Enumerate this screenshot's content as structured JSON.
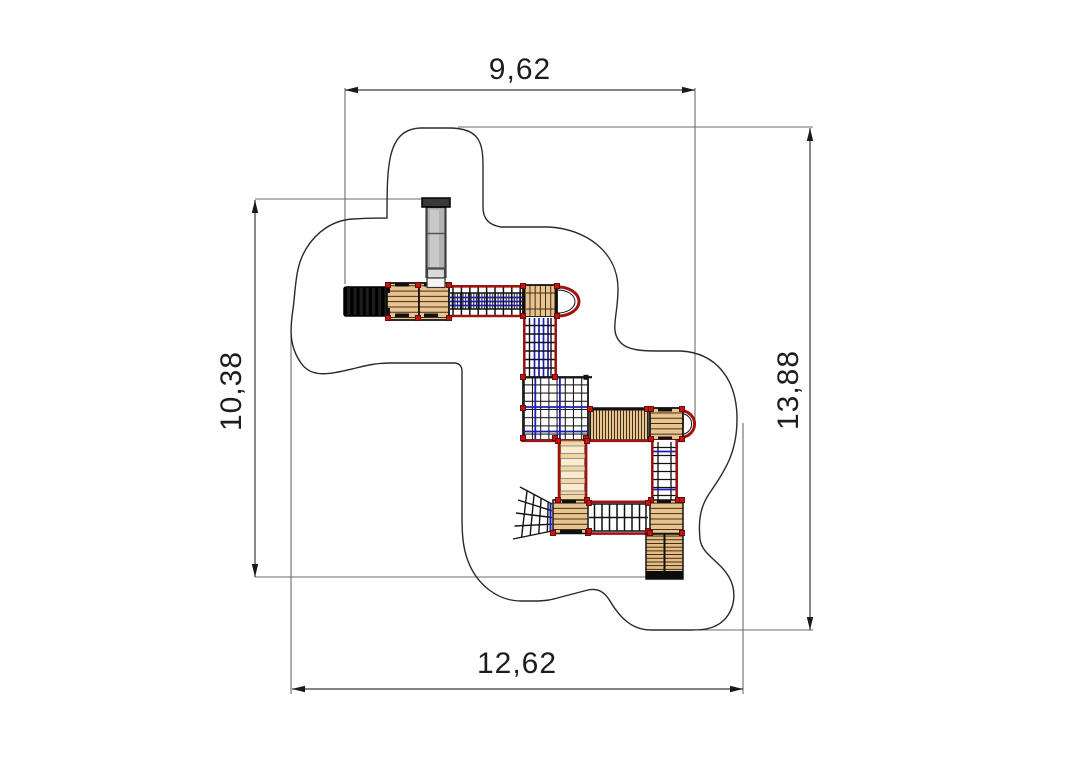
{
  "drawing": {
    "kind": "playground-structure-plan-top-view",
    "dimensions": {
      "top_width": "9,62",
      "left_height": "10,38",
      "right_height": "13,88",
      "bottom_width": "12,62"
    },
    "colors": {
      "rail_red": "#9e1410",
      "node_red": "#c41414",
      "net_blue": "#1e1eb4",
      "wood": "#eac48f",
      "wood_line": "#221408",
      "wood_light": "#f2d7a4",
      "wood_band": "#faeccc",
      "ramp_wood": "#e5bc83",
      "black_part": "#1d1d1d",
      "slide_gray": "#b3b3b3",
      "outline": "#2a2a2a",
      "dim_line": "#3a3a3a",
      "ext_line": "#6b6b6b"
    },
    "components": [
      "safety-zone-boundary",
      "entry-stairs",
      "platform",
      "tube-slide",
      "rope-bridge",
      "climbing-arc",
      "net-wall",
      "climbing-net-platform",
      "plank-bridge",
      "arc-platform",
      "rung-ladder",
      "plank-ladder",
      "fan-climbing-net",
      "monkey-bar-bridge",
      "exit-ramp"
    ]
  }
}
